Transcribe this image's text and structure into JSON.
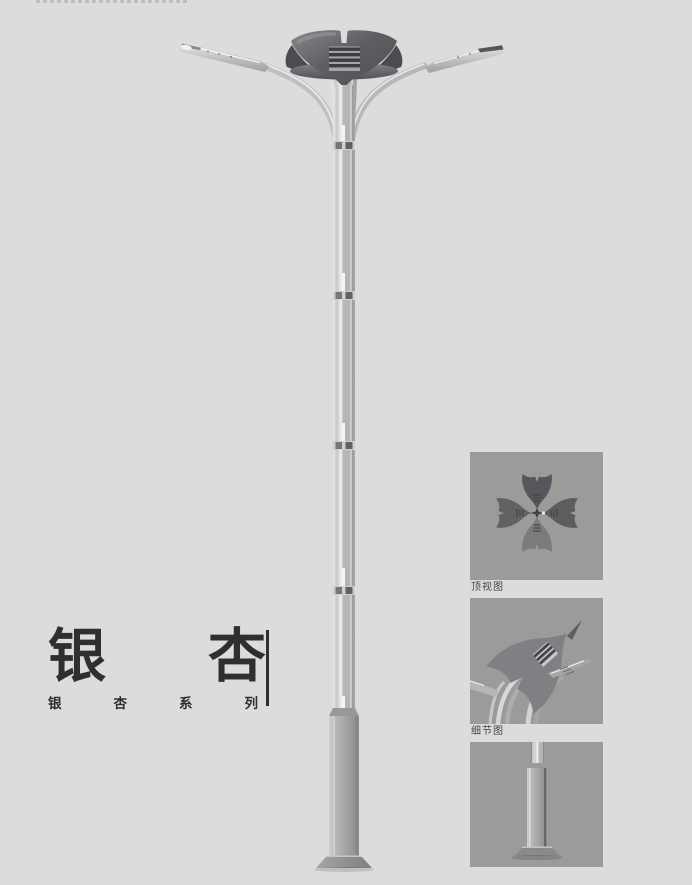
{
  "title_block": {
    "title": "银杏",
    "series": "银杏系列"
  },
  "side_panels": {
    "top_view": {
      "label": "顶视图"
    },
    "detail_view": {
      "label": "细节图"
    },
    "base_view": {
      "label": ""
    }
  },
  "colors": {
    "page-bg": "#dcdcdb",
    "panel-bg": "#9b9b99",
    "ink": "#302f2d",
    "label-ink": "#454543",
    "crown-dark": "#54555a",
    "metal-light": "#d6d7d5",
    "metal-mid": "#b0b1af",
    "metal-dark": "#8e8f8d"
  }
}
